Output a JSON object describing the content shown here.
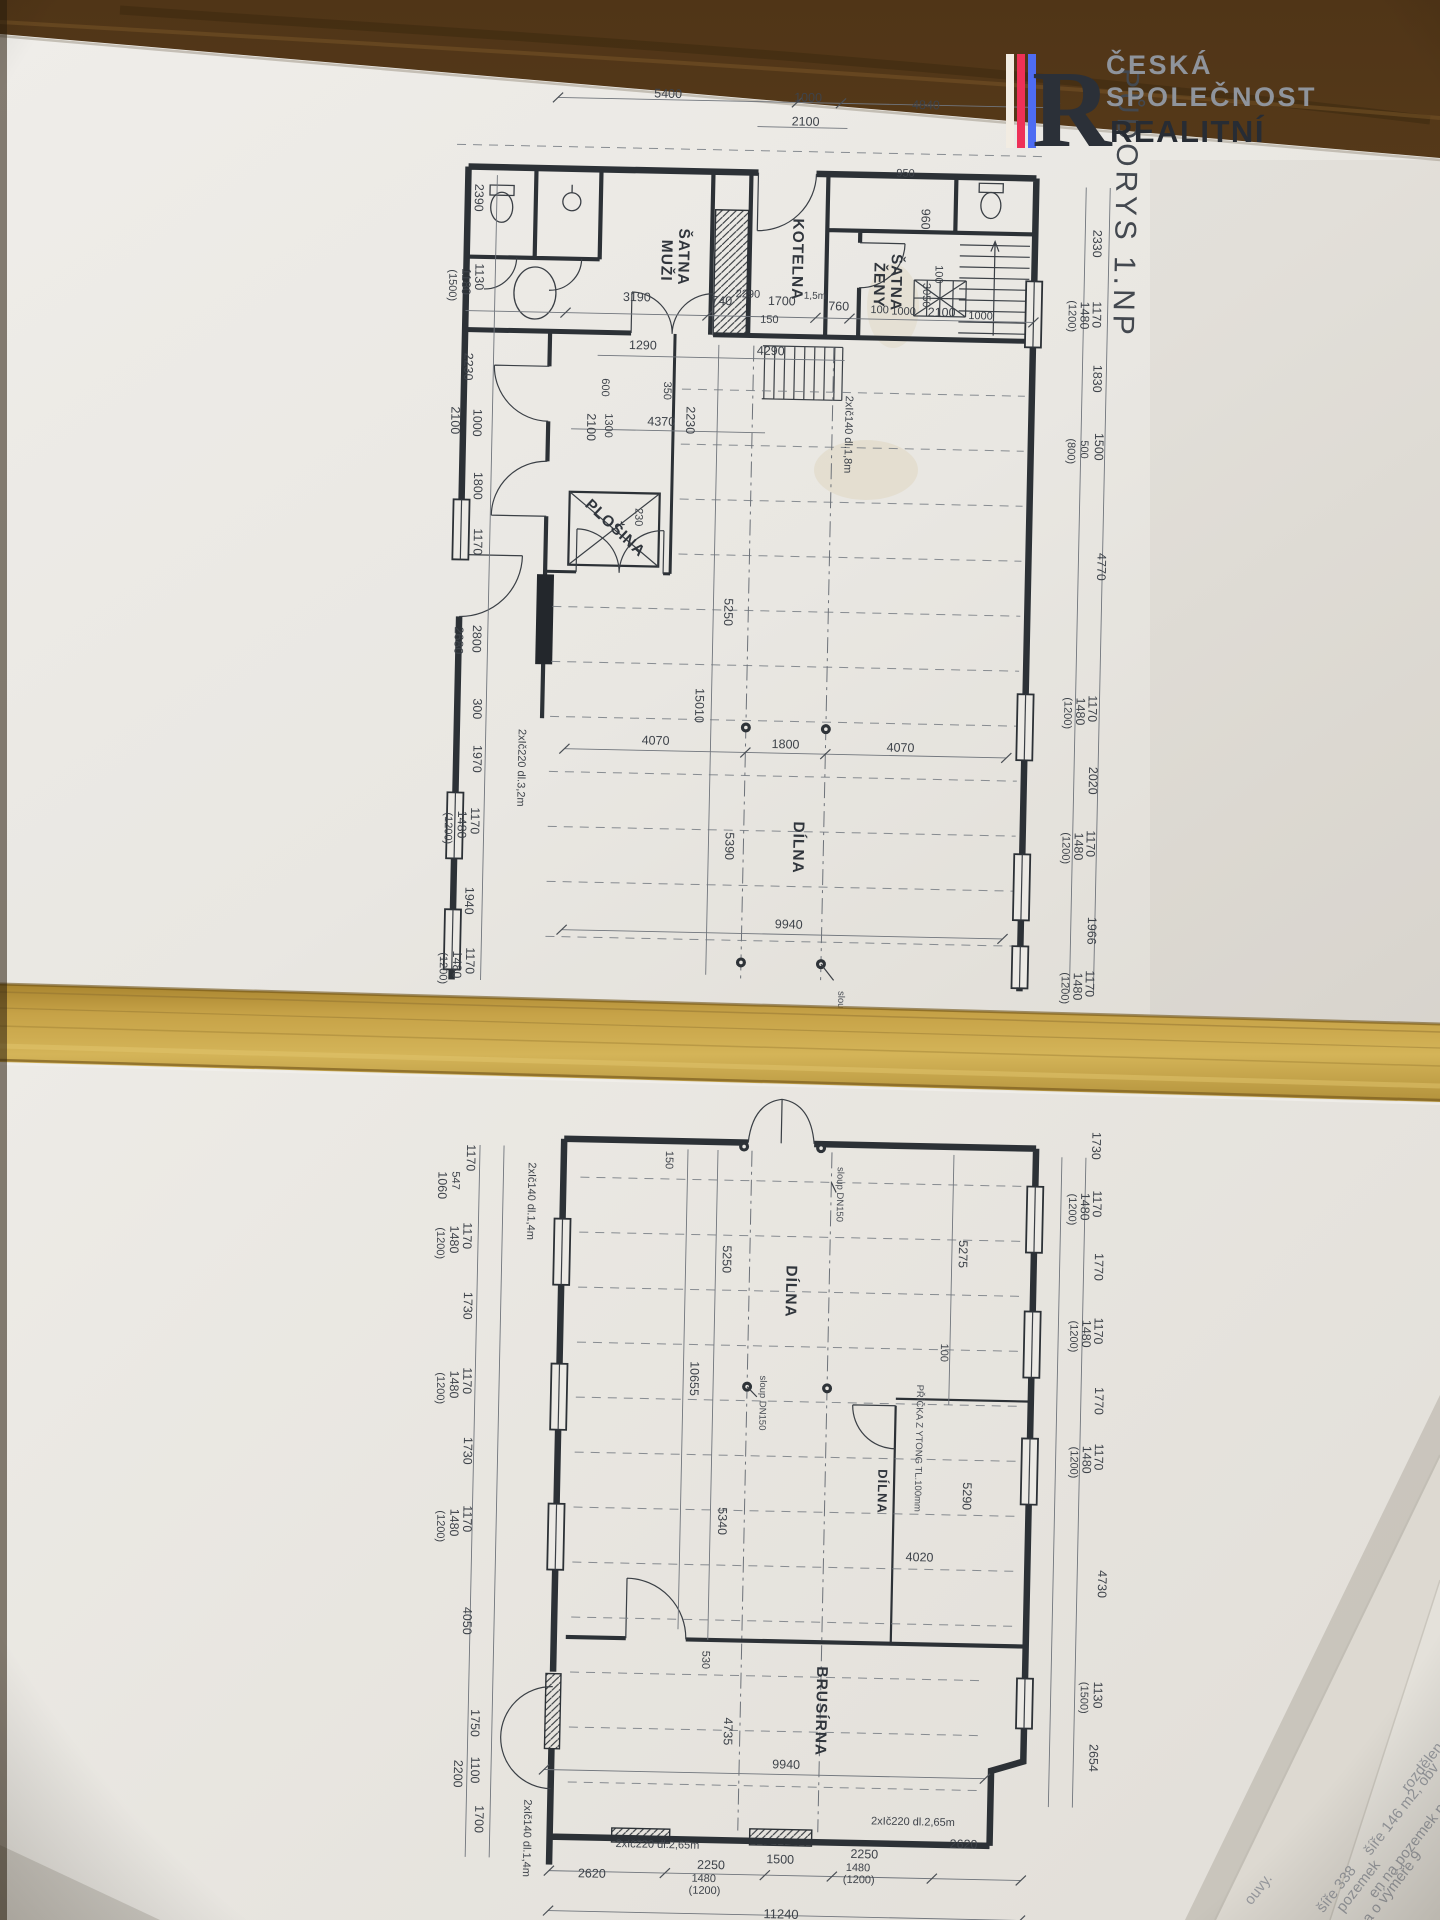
{
  "branding": {
    "letter": "R",
    "line1": "ČESKÁ",
    "line2": "SPOLEČNOST",
    "line3": "REALITNÍ",
    "stripes": [
      "#f2ece2",
      "#ee3157",
      "#4e6cf2"
    ],
    "color_light_text": "#8f949c",
    "color_dark_text": "#272c34"
  },
  "title": {
    "text": "PŮDORYS 1.NP"
  },
  "plan": {
    "room_labels": [
      {
        "t": "ŠATNA",
        "x": 664,
        "y": 258,
        "r": 90
      },
      {
        "t": "MUŽI",
        "x": 647,
        "y": 262,
        "r": 90
      },
      {
        "t": "KOTELNA",
        "x": 778,
        "y": 258,
        "r": 90
      },
      {
        "t": "ŠATNA",
        "x": 877,
        "y": 279,
        "r": 90
      },
      {
        "t": "ŽENY",
        "x": 860,
        "y": 282,
        "r": 90
      },
      {
        "t": "PLOŠINA",
        "x": 603,
        "y": 534,
        "r": 42
      },
      {
        "t": "DÍLNA",
        "x": 791,
        "y": 846,
        "r": 90
      },
      {
        "t": "DÍLNA",
        "x": 793,
        "y": 1290,
        "r": 90
      },
      {
        "t": "DÍLNA",
        "x": 889,
        "y": 1488,
        "r": 90,
        "s": 13
      },
      {
        "t": "BRUSÍRNA",
        "x": 832,
        "y": 1709,
        "r": 90
      }
    ],
    "dim_labels": [
      {
        "t": "5400",
        "x": 650,
        "y": 99,
        "r": 0
      },
      {
        "t": "1000",
        "x": 790,
        "y": 100,
        "r": 0
      },
      {
        "t": "2100",
        "x": 788,
        "y": 124,
        "r": 0
      },
      {
        "t": "4840",
        "x": 908,
        "y": 105,
        "r": 0
      },
      {
        "t": "2390",
        "x": 459,
        "y": 203,
        "r": 90
      },
      {
        "t": "1130",
        "x": 461,
        "y": 282,
        "r": 90
      },
      {
        "t": "1180",
        "x": 448,
        "y": 287,
        "r": 90
      },
      {
        "t": "(1500)",
        "x": 435,
        "y": 291,
        "r": 90,
        "s": 11
      },
      {
        "t": "2230",
        "x": 452,
        "y": 372,
        "r": 90
      },
      {
        "t": "1000",
        "x": 462,
        "y": 428,
        "r": 90
      },
      {
        "t": "2100",
        "x": 440,
        "y": 426,
        "r": 90
      },
      {
        "t": "1800",
        "x": 464,
        "y": 491,
        "r": 90
      },
      {
        "t": "1170",
        "x": 465,
        "y": 547,
        "r": 90
      },
      {
        "t": "2800",
        "x": 466,
        "y": 644,
        "r": 90
      },
      {
        "t": "2680",
        "x": 448,
        "y": 646,
        "r": 90
      },
      {
        "t": "300",
        "x": 468,
        "y": 714,
        "r": 90
      },
      {
        "t": "1970",
        "x": 469,
        "y": 764,
        "r": 90
      },
      {
        "t": "1170",
        "x": 468,
        "y": 826,
        "r": 90
      },
      {
        "t": "1480",
        "x": 455,
        "y": 830,
        "r": 90
      },
      {
        "t": "(1200)",
        "x": 442,
        "y": 834,
        "r": 90,
        "s": 11
      },
      {
        "t": "1940",
        "x": 464,
        "y": 906,
        "r": 90
      },
      {
        "t": "1170",
        "x": 466,
        "y": 966,
        "r": 90
      },
      {
        "t": "1480",
        "x": 453,
        "y": 970,
        "r": 90
      },
      {
        "t": "(1200)",
        "x": 440,
        "y": 974,
        "r": 90,
        "s": 11
      },
      {
        "t": "392",
        "x": 455,
        "y": 1036,
        "r": 90
      },
      {
        "t": "3190",
        "x": 623,
        "y": 303,
        "r": 0
      },
      {
        "t": "740",
        "x": 708,
        "y": 305,
        "r": 0
      },
      {
        "t": "1700",
        "x": 768,
        "y": 304,
        "r": 0
      },
      {
        "t": "150",
        "x": 756,
        "y": 322,
        "r": 0,
        "s": 11
      },
      {
        "t": "760",
        "x": 825,
        "y": 308,
        "r": 0
      },
      {
        "t": "100",
        "x": 866,
        "y": 310,
        "r": 0,
        "s": 11
      },
      {
        "t": "1000",
        "x": 890,
        "y": 311,
        "r": 0,
        "s": 11
      },
      {
        "t": "2100",
        "x": 928,
        "y": 312,
        "r": 0
      },
      {
        "t": "1000",
        "x": 967,
        "y": 314,
        "r": 0,
        "s": 11
      },
      {
        "t": "100",
        "x": 921,
        "y": 270,
        "r": 90,
        "s": 11
      },
      {
        "t": "3050",
        "x": 909,
        "y": 291,
        "r": 90,
        "s": 11
      },
      {
        "t": "960",
        "x": 906,
        "y": 215,
        "r": 90
      },
      {
        "t": "950",
        "x": 889,
        "y": 173,
        "r": 0,
        "s": 11
      },
      {
        "t": "2290",
        "x": 734,
        "y": 297,
        "r": 0,
        "s": 11
      },
      {
        "t": "1,5m",
        "x": 801,
        "y": 297,
        "r": 0,
        "s": 10
      },
      {
        "t": "1290",
        "x": 630,
        "y": 351,
        "r": 0
      },
      {
        "t": "4290",
        "x": 758,
        "y": 354,
        "r": 0
      },
      {
        "t": "4370",
        "x": 650,
        "y": 427,
        "r": 0
      },
      {
        "t": "2230",
        "x": 675,
        "y": 421,
        "r": 90
      },
      {
        "t": "350",
        "x": 652,
        "y": 392,
        "r": 90,
        "s": 11
      },
      {
        "t": "600",
        "x": 590,
        "y": 390,
        "r": 90,
        "s": 11
      },
      {
        "t": "1300",
        "x": 594,
        "y": 428,
        "r": 90,
        "s": 11
      },
      {
        "t": "2100",
        "x": 576,
        "y": 430,
        "r": 90
      },
      {
        "t": "230",
        "x": 626,
        "y": 519,
        "r": 90,
        "s": 11
      },
      {
        "t": "5250",
        "x": 717,
        "y": 612,
        "r": 90
      },
      {
        "t": "15010",
        "x": 690,
        "y": 706,
        "r": 90
      },
      {
        "t": "4070",
        "x": 651,
        "y": 746,
        "r": 0
      },
      {
        "t": "1800",
        "x": 781,
        "y": 747,
        "r": 0
      },
      {
        "t": "4070",
        "x": 896,
        "y": 748,
        "r": 0
      },
      {
        "t": "5390",
        "x": 723,
        "y": 846,
        "r": 90
      },
      {
        "t": "9940",
        "x": 788,
        "y": 927,
        "r": 0
      },
      {
        "t": "2xIč220 dl.3,2m",
        "x": 514,
        "y": 772,
        "r": 90,
        "s": 11
      },
      {
        "t": "2xIč140 dl.1,8m",
        "x": 834,
        "y": 432,
        "r": 90,
        "s": 11
      },
      {
        "t": "2330",
        "x": 1078,
        "y": 236,
        "r": 90
      },
      {
        "t": "1170",
        "x": 1079,
        "y": 307,
        "r": 90
      },
      {
        "t": "1480",
        "x": 1067,
        "y": 308,
        "r": 90
      },
      {
        "t": "(1200)",
        "x": 1055,
        "y": 309,
        "r": 90,
        "s": 11
      },
      {
        "t": "1830",
        "x": 1081,
        "y": 371,
        "r": 90
      },
      {
        "t": "1500",
        "x": 1084,
        "y": 439,
        "r": 90
      },
      {
        "t": "500",
        "x": 1070,
        "y": 442,
        "r": 90,
        "s": 11
      },
      {
        "t": "(800)",
        "x": 1057,
        "y": 444,
        "r": 90,
        "s": 11
      },
      {
        "t": "4770",
        "x": 1089,
        "y": 559,
        "r": 90
      },
      {
        "t": "1170",
        "x": 1083,
        "y": 701,
        "r": 90
      },
      {
        "t": "1480",
        "x": 1071,
        "y": 704,
        "r": 90
      },
      {
        "t": "(1200)",
        "x": 1059,
        "y": 706,
        "r": 90,
        "s": 11
      },
      {
        "t": "2020",
        "x": 1085,
        "y": 773,
        "r": 90
      },
      {
        "t": "1170",
        "x": 1084,
        "y": 836,
        "r": 90
      },
      {
        "t": "1480",
        "x": 1072,
        "y": 839,
        "r": 90
      },
      {
        "t": "(1200)",
        "x": 1060,
        "y": 841,
        "r": 90,
        "s": 11
      },
      {
        "t": "1966",
        "x": 1087,
        "y": 923,
        "r": 90
      },
      {
        "t": "1170",
        "x": 1086,
        "y": 976,
        "r": 90
      },
      {
        "t": "1480",
        "x": 1074,
        "y": 979,
        "r": 90
      },
      {
        "t": "(1200)",
        "x": 1062,
        "y": 981,
        "r": 90,
        "s": 11
      },
      {
        "t": "1170",
        "x": 1091,
        "y": 1063,
        "r": 90
      },
      {
        "t": "4595",
        "x": 720,
        "y": 1056,
        "r": 90
      },
      {
        "t": "150",
        "x": 670,
        "y": 1161,
        "r": 90,
        "s": 11
      },
      {
        "t": "1170",
        "x": 471,
        "y": 1163,
        "r": 90
      },
      {
        "t": "547",
        "x": 457,
        "y": 1186,
        "r": 90,
        "s": 11
      },
      {
        "t": "1060",
        "x": 443,
        "y": 1191,
        "r": 90
      },
      {
        "t": "2xIč140 dl.1,4m",
        "x": 533,
        "y": 1205,
        "r": 90,
        "s": 11
      },
      {
        "t": "1170",
        "x": 469,
        "y": 1241,
        "r": 90
      },
      {
        "t": "1480",
        "x": 456,
        "y": 1245,
        "r": 90
      },
      {
        "t": "(1200)",
        "x": 443,
        "y": 1249,
        "r": 90,
        "s": 11
      },
      {
        "t": "1730",
        "x": 471,
        "y": 1311,
        "r": 90
      },
      {
        "t": "1170",
        "x": 472,
        "y": 1386,
        "r": 90
      },
      {
        "t": "1480",
        "x": 459,
        "y": 1390,
        "r": 90
      },
      {
        "t": "(1200)",
        "x": 446,
        "y": 1394,
        "r": 90,
        "s": 11
      },
      {
        "t": "1730",
        "x": 474,
        "y": 1456,
        "r": 90
      },
      {
        "t": "1170",
        "x": 475,
        "y": 1524,
        "r": 90
      },
      {
        "t": "1480",
        "x": 462,
        "y": 1528,
        "r": 90
      },
      {
        "t": "(1200)",
        "x": 449,
        "y": 1532,
        "r": 90,
        "s": 11
      },
      {
        "t": "4050",
        "x": 477,
        "y": 1626,
        "r": 90
      },
      {
        "t": "1750",
        "x": 487,
        "y": 1728,
        "r": 90
      },
      {
        "t": "2200",
        "x": 471,
        "y": 1779,
        "r": 90
      },
      {
        "t": "1100",
        "x": 488,
        "y": 1775,
        "r": 90
      },
      {
        "t": "1700",
        "x": 493,
        "y": 1824,
        "r": 90
      },
      {
        "t": "2xIč140 dl.1,4m",
        "x": 542,
        "y": 1842,
        "r": 90,
        "s": 11
      },
      {
        "t": "5250",
        "x": 729,
        "y": 1259,
        "r": 90
      },
      {
        "t": "5275",
        "x": 965,
        "y": 1249,
        "r": 90
      },
      {
        "t": "100",
        "x": 949,
        "y": 1348,
        "r": 90,
        "s": 11
      },
      {
        "t": "10655",
        "x": 699,
        "y": 1379,
        "r": 90
      },
      {
        "t": "5340",
        "x": 730,
        "y": 1521,
        "r": 90
      },
      {
        "t": "5290",
        "x": 974,
        "y": 1491,
        "r": 90
      },
      {
        "t": "4020",
        "x": 932,
        "y": 1557,
        "r": 0
      },
      {
        "t": "530",
        "x": 717,
        "y": 1660,
        "r": 90,
        "s": 11
      },
      {
        "t": "4735",
        "x": 740,
        "y": 1731,
        "r": 90
      },
      {
        "t": "9940",
        "x": 803,
        "y": 1767,
        "r": 0
      },
      {
        "t": "1730",
        "x": 1096,
        "y": 1138,
        "r": 90
      },
      {
        "t": "1170",
        "x": 1098,
        "y": 1196,
        "r": 90
      },
      {
        "t": "1480",
        "x": 1086,
        "y": 1199,
        "r": 90
      },
      {
        "t": "(1200)",
        "x": 1074,
        "y": 1202,
        "r": 90,
        "s": 11
      },
      {
        "t": "1770",
        "x": 1101,
        "y": 1259,
        "r": 90
      },
      {
        "t": "1170",
        "x": 1102,
        "y": 1323,
        "r": 90
      },
      {
        "t": "1480",
        "x": 1090,
        "y": 1326,
        "r": 90
      },
      {
        "t": "(1200)",
        "x": 1078,
        "y": 1329,
        "r": 90,
        "s": 11
      },
      {
        "t": "1770",
        "x": 1104,
        "y": 1393,
        "r": 90
      },
      {
        "t": "1170",
        "x": 1105,
        "y": 1449,
        "r": 90
      },
      {
        "t": "1480",
        "x": 1093,
        "y": 1452,
        "r": 90
      },
      {
        "t": "(1200)",
        "x": 1081,
        "y": 1455,
        "r": 90,
        "s": 11
      },
      {
        "t": "4730",
        "x": 1111,
        "y": 1576,
        "r": 90
      },
      {
        "t": "1130",
        "x": 1109,
        "y": 1687,
        "r": 90
      },
      {
        "t": "(1500)",
        "x": 1096,
        "y": 1690,
        "r": 90,
        "s": 11
      },
      {
        "t": "2654",
        "x": 1106,
        "y": 1750,
        "r": 90
      },
      {
        "t": "2xIč220 dl.2,65m",
        "x": 676,
        "y": 1849,
        "r": 0,
        "s": 11
      },
      {
        "t": "2xIč220 dl.2,65m",
        "x": 931,
        "y": 1821,
        "r": 0,
        "s": 11
      },
      {
        "t": "2620",
        "x": 982,
        "y": 1843,
        "r": 0
      },
      {
        "t": "2250",
        "x": 883,
        "y": 1855,
        "r": 0
      },
      {
        "t": "1480",
        "x": 877,
        "y": 1868,
        "r": 0,
        "s": 11
      },
      {
        "t": "(1200)",
        "x": 878,
        "y": 1880,
        "r": 0,
        "s": 11
      },
      {
        "t": "1500",
        "x": 799,
        "y": 1862,
        "r": 0
      },
      {
        "t": "2250",
        "x": 730,
        "y": 1869,
        "r": 0
      },
      {
        "t": "1480",
        "x": 723,
        "y": 1882,
        "r": 0,
        "s": 11
      },
      {
        "t": "(1200)",
        "x": 724,
        "y": 1894,
        "r": 0,
        "s": 11
      },
      {
        "t": "2620",
        "x": 611,
        "y": 1880,
        "r": 0
      },
      {
        "t": "11240",
        "x": 801,
        "y": 1917,
        "r": 0,
        "s": 13
      }
    ],
    "note_labels": [
      {
        "t": "PŘÍČKA Z YTONG TL.100mm",
        "x": 926,
        "y": 1444,
        "r": 90
      },
      {
        "t": "sloup DN150",
        "x": 842,
        "y": 1192,
        "r": 90
      },
      {
        "t": "sloup DN150",
        "x": 839,
        "y": 1016,
        "r": 90
      },
      {
        "t": "sloup DN150",
        "x": 769,
        "y": 1402,
        "r": 90
      }
    ]
  },
  "under_paper": {
    "lines": [
      {
        "t": "rozdělen",
        "x": 1426,
        "y": 1770,
        "r": -52
      },
      {
        "t": "šíře 146 m2, obv",
        "x": 1405,
        "y": 1812,
        "r": -52
      },
      {
        "t": "en na pozemek p.",
        "x": 1412,
        "y": 1852,
        "r": -52
      },
      {
        "t": "a o výměře 9",
        "x": 1396,
        "y": 1890,
        "r": -52
      },
      {
        "t": "pozemek",
        "x": 1362,
        "y": 1889,
        "r": -52
      },
      {
        "t": "šíře 338",
        "x": 1340,
        "y": 1892,
        "r": -52
      },
      {
        "t": "ouvy.",
        "x": 1262,
        "y": 1892,
        "r": -52
      }
    ]
  }
}
